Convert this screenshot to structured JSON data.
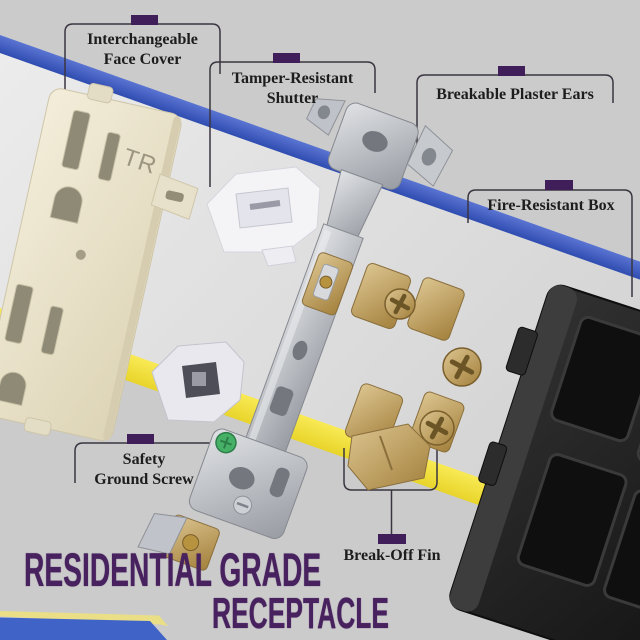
{
  "colors": {
    "background": "#cbcbcb",
    "light_band": "#e4e4e4",
    "stripe_blue": "#3d5ec4",
    "stripe_yellow": "#f3e23c",
    "accent_purple": "#3f1e5a",
    "title_purple": "#48215f",
    "callout_line": "#3a3540",
    "face_cover_cream": "#e9e3cf",
    "metal_silver": "#b9bcc2",
    "brass": "#c2a266",
    "rear_box_black": "#232323",
    "ground_screw_green": "#46b166",
    "ribbon_blue": "#4063c8",
    "ribbon_yellow": "#eadf87"
  },
  "callouts": {
    "face_cover": {
      "lines": [
        "Interchangeable",
        "Face Cover"
      ]
    },
    "shutter": {
      "lines": [
        "Tamper-Resistant",
        "Shutter"
      ]
    },
    "plaster_ears": {
      "lines": [
        "Breakable Plaster Ears"
      ]
    },
    "fire_box": {
      "lines": [
        "Fire-Resistant Box"
      ]
    },
    "ground_screw": {
      "lines": [
        "Safety",
        "Ground Screw"
      ]
    },
    "break_off_fin": {
      "lines": [
        "Break-Off Fin"
      ]
    }
  },
  "title": {
    "line1": "RESIDENTIAL GRADE",
    "line2": "RECEPTACLE"
  },
  "parts": {
    "face_marking": "TR"
  }
}
